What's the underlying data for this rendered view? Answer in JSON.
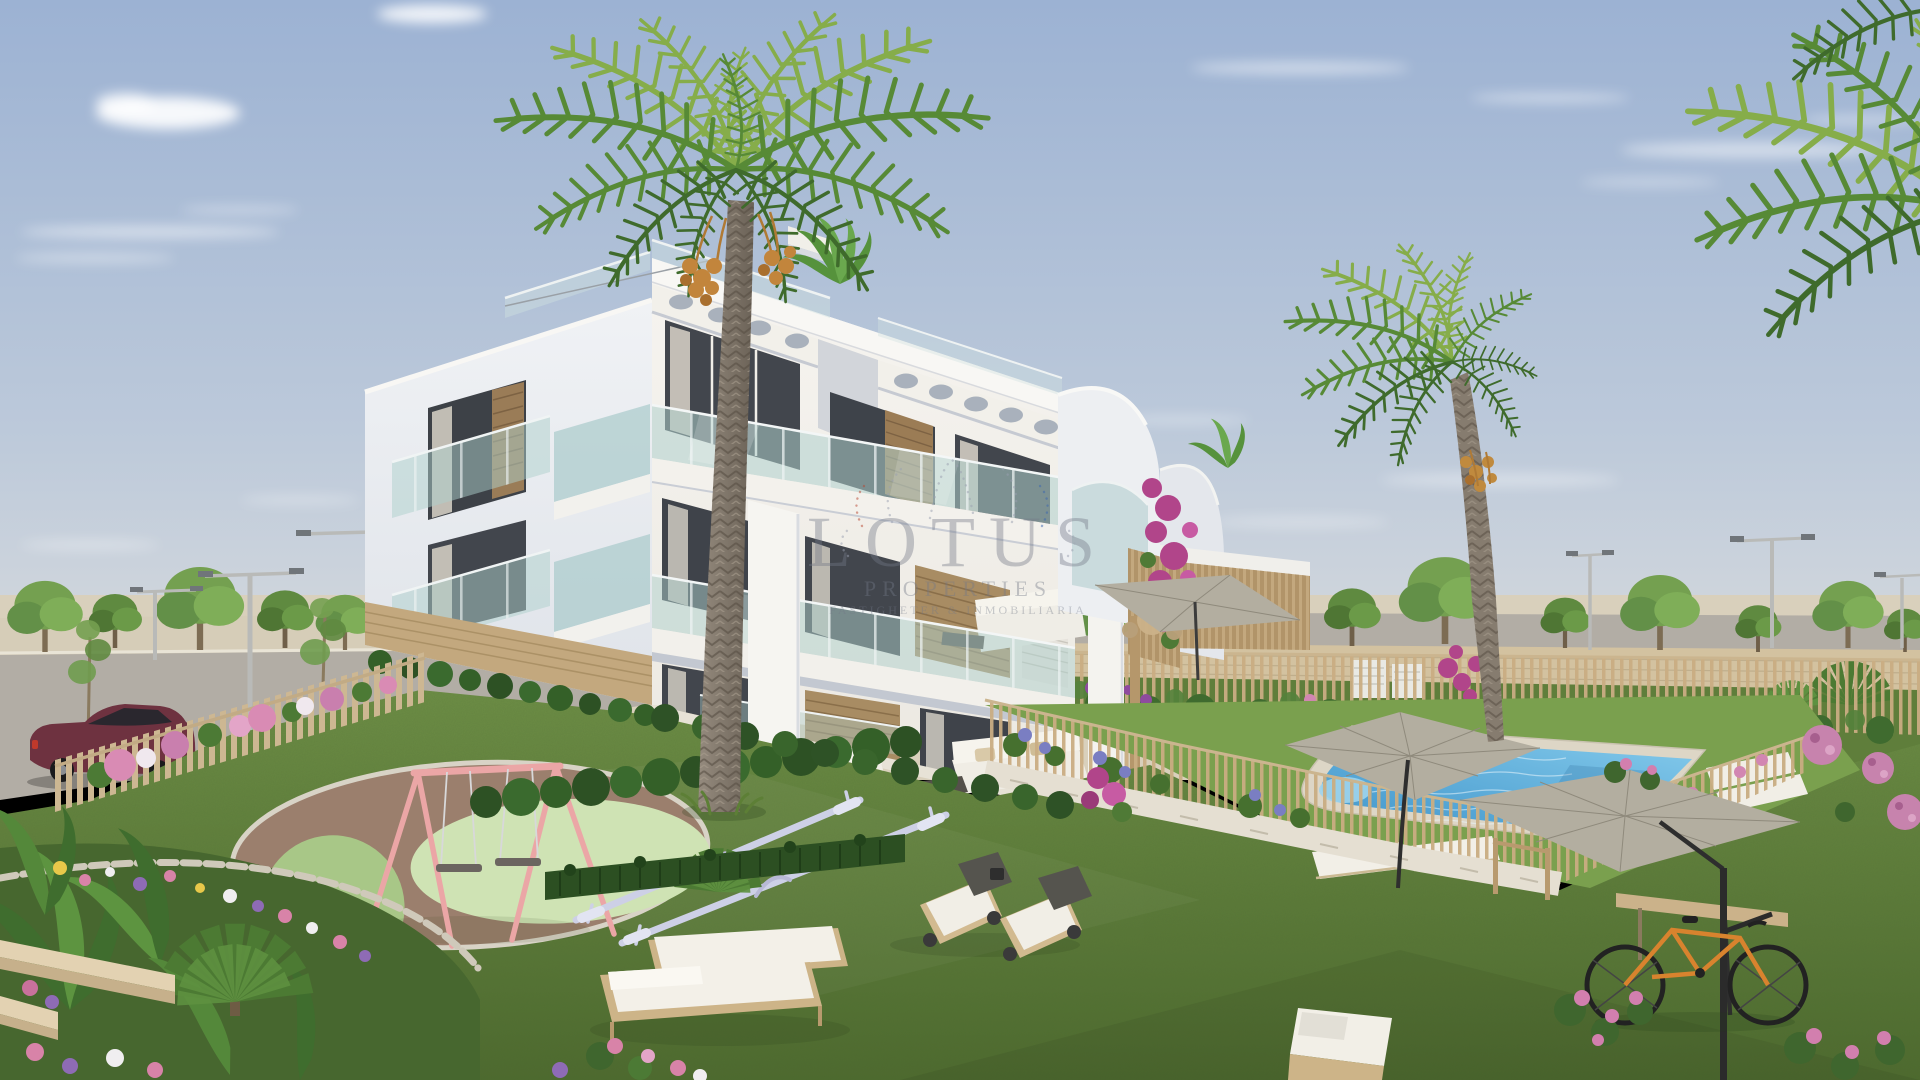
{
  "image": {
    "width": 1920,
    "height": 1080,
    "kind": "architectural-exterior-render",
    "subject": "Modern white three-storey apartment complex with communal garden, swimming pool, playground and palm trees"
  },
  "watermark": {
    "brand": "LOTUS",
    "line2": "PROPERTIES",
    "line3": "FASTIGHETER & INMOBILIARIA"
  },
  "scene": {
    "storeys": 3,
    "palm_trees_large": 2,
    "parasols": 3,
    "sun_loungers": 9,
    "street_lamps": 6,
    "vehicles": 1,
    "bicycles": 1,
    "background_trees": 15
  },
  "palette": {
    "sky_top": "#9cb2d3",
    "sky_mid": "#bcc9da",
    "sky_horizon": "#e1e1df",
    "facade_white": "#f6f4f0",
    "facade_cream": "#ece9e2",
    "gable_shade_top": "#f0f2f5",
    "gable_shade_bottom": "#dfe3e9",
    "glass_teal": "#aed0cc",
    "wood_tan": "#c3a87e",
    "lawn_light": "#6e8f46",
    "lawn_dark": "#4d6a2e",
    "turf_green": "#7aa04e",
    "pool_deep": "#3e93c9",
    "pool_light": "#85cbec",
    "palm_dark": "#3f6b2c",
    "palm_mid": "#578a36",
    "palm_light": "#86ad4a",
    "umbrella_grey": "#b3aea0",
    "car_maroon": "#6e3240",
    "swing_pink": "#eba6a6",
    "seesaw_lilac": "#cdd0e6",
    "bike_orange": "#d8832e",
    "flower_magenta": "#b1458a",
    "flower_pink": "#d286b2",
    "stone_beige": "#e3ddd0",
    "watermark_grey": "#737a88"
  }
}
